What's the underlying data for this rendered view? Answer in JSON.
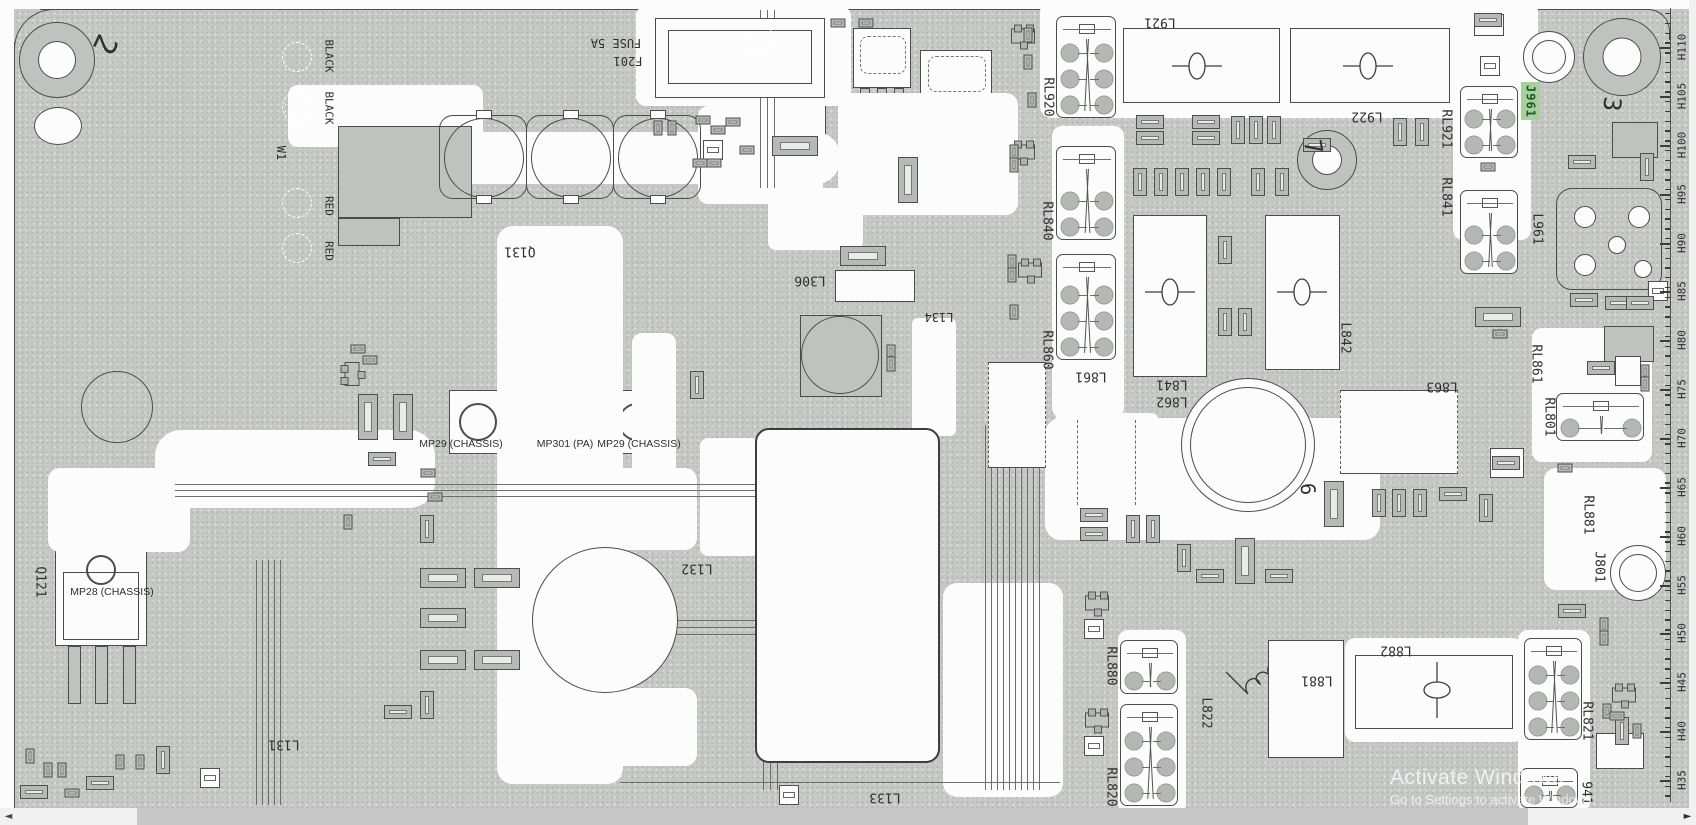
{
  "viewer": {
    "watermark_line1": "Activate Windows",
    "watermark_line2": "Go to Settings to activate Windows.",
    "hscroll_left_arrow": "◄",
    "hscroll_right_arrow": "►"
  },
  "highlight": {
    "text": "J961",
    "bg": "#a9cfa0",
    "fg": "#1d5a1d"
  },
  "ruler": {
    "x": 1670,
    "top": 8,
    "bottom": 802,
    "minor_step": 9.78,
    "labels": [
      [
        "H110",
        47
      ],
      [
        "H105",
        96
      ],
      [
        "H100",
        145
      ],
      [
        "H95",
        194
      ],
      [
        "H90",
        243
      ],
      [
        "H85",
        291
      ],
      [
        "H80",
        340
      ],
      [
        "H75",
        389
      ],
      [
        "H70",
        438
      ],
      [
        "H65",
        487
      ],
      [
        "H60",
        536
      ],
      [
        "H55",
        585
      ],
      [
        "H50",
        633
      ],
      [
        "H45",
        682
      ],
      [
        "H40",
        731
      ],
      [
        "H35",
        780
      ]
    ]
  },
  "labels": [
    [
      "2",
      104,
      44,
      115,
      30
    ],
    [
      "BLACK",
      329,
      56,
      90,
      11
    ],
    [
      "BLACK",
      329,
      108,
      90,
      11
    ],
    [
      "W1",
      281,
      153,
      90,
      12
    ],
    [
      "RED",
      329,
      206,
      90,
      11
    ],
    [
      "RED",
      329,
      251,
      90,
      11
    ],
    [
      "FUSE 5A",
      616,
      43,
      180,
      12
    ],
    [
      "F201",
      628,
      61,
      180,
      12
    ],
    [
      "Q131",
      520,
      251,
      180,
      13
    ],
    [
      "L306",
      810,
      280,
      180,
      13
    ],
    [
      "L134",
      939,
      317,
      180,
      12
    ],
    [
      "MP29 (CHASSIS)",
      461,
      444,
      0,
      10.5,
      1
    ],
    [
      "MP301 (PA)",
      565,
      444,
      0,
      10.5,
      1
    ],
    [
      "MP29 (CHASSIS)",
      639,
      444,
      0,
      10.5,
      1
    ],
    [
      "Q121",
      40,
      582,
      90,
      13
    ],
    [
      "MP28 (CHASSIS)",
      112,
      592,
      0,
      10.5,
      1
    ],
    [
      "L131",
      284,
      744,
      180,
      13
    ],
    [
      "L132",
      697,
      568,
      180,
      13
    ],
    [
      "L133",
      885,
      797,
      180,
      13
    ],
    [
      "RL920",
      1048,
      97,
      90,
      13
    ],
    [
      "L921",
      1160,
      22,
      180,
      13
    ],
    [
      "L922",
      1367,
      116,
      180,
      13
    ],
    [
      "RL840",
      1047,
      221,
      90,
      13
    ],
    [
      "RL860",
      1047,
      350,
      90,
      13
    ],
    [
      "L861",
      1091,
      376,
      180,
      13
    ],
    [
      "L841",
      1172,
      384,
      180,
      13
    ],
    [
      "L862",
      1172,
      401,
      180,
      13
    ],
    [
      "L842",
      1345,
      338,
      90,
      13
    ],
    [
      "L863",
      1442,
      386,
      180,
      13
    ],
    [
      "RL921",
      1446,
      129,
      90,
      13
    ],
    [
      "RL841",
      1446,
      197,
      90,
      13
    ],
    [
      "7",
      1313,
      147,
      80,
      24
    ],
    [
      "3",
      1612,
      104,
      95,
      24
    ],
    [
      "6",
      1308,
      489,
      85,
      20
    ],
    [
      "L961",
      1537,
      229,
      90,
      13
    ],
    [
      "RL861",
      1536,
      364,
      90,
      13
    ],
    [
      "RL801",
      1549,
      417,
      90,
      13
    ],
    [
      "RL881",
      1588,
      515,
      90,
      13
    ],
    [
      "J801",
      1599,
      567,
      90,
      13
    ],
    [
      "RL880",
      1111,
      666,
      90,
      13
    ],
    [
      "RL820",
      1111,
      787,
      90,
      13
    ],
    [
      "L822",
      1206,
      713,
      90,
      13
    ],
    [
      "L881",
      1317,
      680,
      180,
      13
    ],
    [
      "L882",
      1396,
      650,
      180,
      13
    ],
    [
      "RL821",
      1587,
      721,
      90,
      13
    ],
    [
      "941",
      1586,
      793,
      90,
      13
    ]
  ],
  "white_regions": [
    [
      288,
      85,
      195,
      62,
      10
    ],
    [
      420,
      132,
      420,
      52,
      24
    ],
    [
      636,
      6,
      215,
      100,
      10
    ],
    [
      698,
      106,
      125,
      98,
      10
    ],
    [
      838,
      93,
      180,
      122,
      12
    ],
    [
      497,
      226,
      126,
      558,
      16
    ],
    [
      632,
      333,
      44,
      192,
      10
    ],
    [
      573,
      468,
      124,
      82,
      12
    ],
    [
      563,
      688,
      134,
      78,
      12
    ],
    [
      700,
      438,
      60,
      118,
      8
    ],
    [
      912,
      318,
      44,
      118,
      6
    ],
    [
      1040,
      0,
      498,
      118,
      12
    ],
    [
      1052,
      126,
      72,
      292,
      10
    ],
    [
      1453,
      72,
      78,
      168,
      10
    ],
    [
      1045,
      418,
      335,
      122,
      16
    ],
    [
      1055,
      413,
      104,
      92,
      8
    ],
    [
      1118,
      630,
      68,
      184,
      10
    ],
    [
      1518,
      630,
      72,
      182,
      10
    ],
    [
      1544,
      468,
      122,
      122,
      12
    ],
    [
      1532,
      328,
      120,
      134,
      10
    ],
    [
      155,
      430,
      280,
      78,
      26
    ],
    [
      48,
      468,
      142,
      84,
      12
    ],
    [
      943,
      583,
      120,
      214,
      14
    ],
    [
      1345,
      638,
      178,
      104,
      10
    ],
    [
      768,
      188,
      95,
      62,
      8
    ]
  ],
  "boxes": [
    [
      1123,
      28,
      157,
      75,
      0
    ],
    [
      1290,
      28,
      160,
      75,
      0
    ],
    [
      1133,
      215,
      74,
      162,
      0
    ],
    [
      1265,
      215,
      75,
      155,
      0
    ],
    [
      1340,
      390,
      118,
      84,
      2
    ],
    [
      988,
      362,
      58,
      106,
      2
    ],
    [
      1355,
      655,
      158,
      74,
      0
    ],
    [
      1268,
      640,
      76,
      118,
      0
    ],
    [
      835,
      270,
      80,
      32,
      0
    ],
    [
      1612,
      122,
      46,
      36,
      1
    ],
    [
      1604,
      326,
      50,
      36,
      1
    ],
    [
      1490,
      448,
      34,
      30,
      0
    ],
    [
      1596,
      733,
      48,
      36,
      0
    ],
    [
      1474,
      14,
      30,
      22,
      0
    ],
    [
      800,
      315,
      82,
      82,
      1
    ],
    [
      1615,
      356,
      26,
      30,
      0
    ],
    [
      655,
      18,
      170,
      80,
      0
    ],
    [
      668,
      30,
      144,
      54,
      0
    ],
    [
      755,
      428,
      185,
      335,
      3
    ],
    [
      338,
      126,
      134,
      92,
      1
    ],
    [
      338,
      218,
      62,
      28,
      1
    ]
  ],
  "coil_symbols": [
    [
      1197,
      66,
      0
    ],
    [
      1368,
      66,
      0
    ],
    [
      1170,
      292,
      0
    ],
    [
      1302,
      292,
      0
    ],
    [
      1437,
      690,
      1
    ]
  ],
  "circles": [
    [
      117,
      407,
      36,
      0
    ],
    [
      840,
      355,
      39,
      0
    ],
    [
      605,
      620,
      73,
      1
    ],
    [
      1248,
      445,
      67,
      2
    ],
    [
      1549,
      57,
      26,
      2
    ],
    [
      1638,
      573,
      28,
      2
    ],
    [
      1327,
      160,
      30,
      3
    ],
    [
      57,
      60,
      38,
      3
    ],
    [
      1622,
      57,
      39,
      3
    ]
  ],
  "dashed_circles": [
    [
      297,
      57
    ],
    [
      297,
      107
    ],
    [
      297,
      203
    ],
    [
      297,
      248
    ],
    [
      758,
      37
    ]
  ],
  "relays": [
    [
      1056,
      16,
      60,
      102
    ],
    [
      1056,
      146,
      60,
      94
    ],
    [
      1056,
      254,
      60,
      106
    ],
    [
      1460,
      86,
      58,
      72
    ],
    [
      1460,
      190,
      58,
      84
    ],
    [
      1120,
      640,
      58,
      54
    ],
    [
      1120,
      704,
      58,
      102
    ],
    [
      1524,
      638,
      58,
      102
    ],
    [
      1520,
      768,
      58,
      40
    ],
    [
      1556,
      393,
      88,
      48
    ]
  ],
  "big_caps": [
    [
      483,
      157
    ],
    [
      570,
      157
    ],
    [
      657,
      157
    ]
  ],
  "sots": [
    [
      1023,
      36,
      0
    ],
    [
      1023,
      152,
      0
    ],
    [
      1030,
      270,
      0
    ],
    [
      352,
      374,
      1
    ],
    [
      1097,
      603,
      0
    ],
    [
      1097,
      720,
      0
    ],
    [
      1624,
      695,
      0
    ]
  ],
  "squares": [
    [
      1094,
      629
    ],
    [
      1094,
      746
    ],
    [
      713,
      150
    ],
    [
      210,
      778
    ],
    [
      789,
      795
    ],
    [
      1658,
      291
    ],
    [
      1490,
      66
    ]
  ],
  "smds": [
    [
      658,
      128,
      1
    ],
    [
      672,
      128,
      1
    ],
    [
      703,
      120,
      0
    ],
    [
      718,
      130,
      0
    ],
    [
      733,
      122,
      0
    ],
    [
      747,
      150,
      0
    ],
    [
      700,
      163,
      0
    ],
    [
      714,
      163,
      0
    ],
    [
      795,
      146,
      4
    ],
    [
      838,
      23,
      0
    ],
    [
      866,
      23,
      0
    ],
    [
      908,
      180,
      5
    ],
    [
      863,
      256,
      4
    ],
    [
      891,
      352,
      1
    ],
    [
      891,
      364,
      1
    ],
    [
      1028,
      35,
      1
    ],
    [
      1028,
      62,
      1
    ],
    [
      1032,
      100,
      1
    ],
    [
      1014,
      152,
      1
    ],
    [
      1014,
      165,
      1
    ],
    [
      1012,
      262,
      1
    ],
    [
      1012,
      275,
      1
    ],
    [
      1014,
      312,
      1
    ],
    [
      1150,
      122,
      2
    ],
    [
      1150,
      138,
      2
    ],
    [
      1206,
      122,
      2
    ],
    [
      1206,
      138,
      2
    ],
    [
      1238,
      130,
      3
    ],
    [
      1256,
      130,
      3
    ],
    [
      1274,
      130,
      3
    ],
    [
      1140,
      182,
      3
    ],
    [
      1161,
      182,
      3
    ],
    [
      1182,
      182,
      3
    ],
    [
      1203,
      182,
      3
    ],
    [
      1224,
      182,
      3
    ],
    [
      1258,
      182,
      3
    ],
    [
      1282,
      182,
      3
    ],
    [
      1400,
      132,
      3
    ],
    [
      1422,
      132,
      3
    ],
    [
      1225,
      250,
      3
    ],
    [
      1225,
      322,
      3
    ],
    [
      1245,
      322,
      3
    ],
    [
      1094,
      515,
      2
    ],
    [
      1094,
      534,
      2
    ],
    [
      1133,
      529,
      3
    ],
    [
      1153,
      529,
      3
    ],
    [
      1184,
      558,
      3
    ],
    [
      1245,
      561,
      5
    ],
    [
      1210,
      576,
      2
    ],
    [
      1279,
      576,
      2
    ],
    [
      1334,
      504,
      5
    ],
    [
      1379,
      503,
      3
    ],
    [
      1399,
      503,
      3
    ],
    [
      1420,
      503,
      3
    ],
    [
      1453,
      494,
      2
    ],
    [
      1486,
      508,
      3
    ],
    [
      1498,
      317,
      4
    ],
    [
      1500,
      334,
      0
    ],
    [
      1506,
      463,
      2
    ],
    [
      1582,
      162,
      2
    ],
    [
      1647,
      167,
      3
    ],
    [
      1584,
      300,
      2
    ],
    [
      1619,
      303,
      2
    ],
    [
      1640,
      303,
      2
    ],
    [
      1601,
      368,
      2
    ],
    [
      1645,
      372,
      1
    ],
    [
      1645,
      384,
      1
    ],
    [
      1565,
      468,
      0
    ],
    [
      1572,
      611,
      2
    ],
    [
      1604,
      625,
      1
    ],
    [
      1604,
      638,
      1
    ],
    [
      1607,
      711,
      1
    ],
    [
      1622,
      731,
      3
    ],
    [
      1637,
      731,
      1
    ],
    [
      1617,
      716,
      0
    ],
    [
      30,
      756,
      1
    ],
    [
      48,
      770,
      1
    ],
    [
      62,
      770,
      1
    ],
    [
      34,
      792,
      2
    ],
    [
      72,
      793,
      0
    ],
    [
      120,
      762,
      1
    ],
    [
      140,
      762,
      1
    ],
    [
      163,
      760,
      3
    ],
    [
      100,
      783,
      2
    ],
    [
      348,
      522,
      1
    ],
    [
      368,
      417,
      5
    ],
    [
      403,
      417,
      5
    ],
    [
      382,
      459,
      2
    ],
    [
      428,
      473,
      0
    ],
    [
      435,
      497,
      0
    ],
    [
      358,
      349,
      0
    ],
    [
      370,
      360,
      0
    ],
    [
      697,
      385,
      3
    ],
    [
      443,
      578,
      4
    ],
    [
      497,
      578,
      4
    ],
    [
      443,
      618,
      4
    ],
    [
      443,
      660,
      4
    ],
    [
      497,
      660,
      4
    ],
    [
      427,
      529,
      3
    ],
    [
      427,
      705,
      3
    ],
    [
      398,
      712,
      2
    ],
    [
      1488,
      20,
      2
    ],
    [
      1488,
      167,
      0
    ],
    [
      1317,
      145,
      2
    ]
  ],
  "trace_lines": [
    [
      175,
      484,
      765,
      1
    ],
    [
      175,
      490,
      765,
      1
    ],
    [
      175,
      496,
      765,
      1
    ],
    [
      763,
      600,
      1,
      190
    ],
    [
      770,
      600,
      1,
      190
    ],
    [
      777,
      600,
      1,
      190
    ],
    [
      620,
      620,
      145,
      1
    ],
    [
      620,
      627,
      150,
      1
    ],
    [
      620,
      634,
      155,
      1
    ],
    [
      620,
      782,
      440,
      1
    ],
    [
      760,
      10,
      1,
      178
    ],
    [
      767,
      10,
      1,
      178
    ],
    [
      774,
      10,
      1,
      178
    ],
    [
      985,
      425,
      1,
      365
    ],
    [
      991,
      425,
      1,
      365
    ],
    [
      997,
      425,
      1,
      365
    ],
    [
      1003,
      425,
      1,
      365
    ],
    [
      1009,
      425,
      1,
      365
    ],
    [
      1015,
      425,
      1,
      365
    ],
    [
      1021,
      425,
      1,
      365
    ],
    [
      1027,
      425,
      1,
      365
    ],
    [
      1033,
      425,
      1,
      365
    ],
    [
      1039,
      425,
      1,
      365
    ],
    [
      256,
      560,
      1,
      245
    ],
    [
      262,
      560,
      1,
      245
    ],
    [
      268,
      560,
      1,
      245
    ],
    [
      274,
      560,
      1,
      245
    ],
    [
      280,
      560,
      1,
      245
    ]
  ],
  "vdashes": [
    [
      769,
      438,
      318
    ],
    [
      922,
      438,
      318
    ],
    [
      1077,
      420,
      85
    ],
    [
      1135,
      420,
      85
    ]
  ]
}
